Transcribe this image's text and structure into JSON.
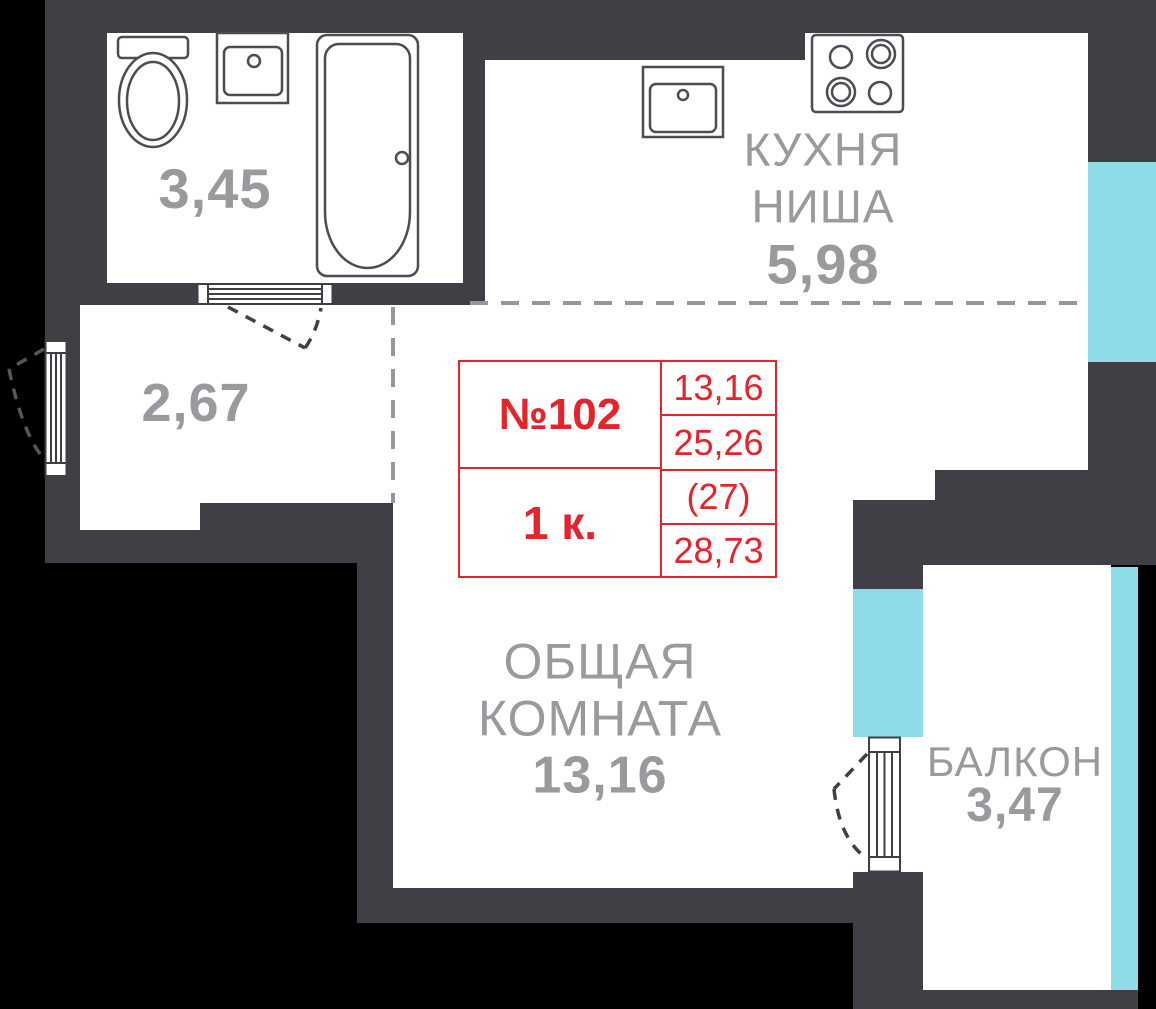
{
  "title": "Апартамент №102 — план",
  "colors": {
    "background": "#000000",
    "wall": "#3f3f45",
    "room_fill": "#ffffff",
    "window_glass": "#8edce8",
    "label_gray": "#9a9a9e",
    "accent_red": "#e4232b"
  },
  "unit": {
    "number": "№102",
    "type": "1 к.",
    "living_area": "13,16",
    "area_excl_balcony": "25,26",
    "area_hint": "(27)",
    "total_area": "28,73"
  },
  "rooms": {
    "bathroom": {
      "area": "3,45"
    },
    "kitchen": {
      "line1": "КУХНЯ",
      "line2": "НИША",
      "area": "5,98"
    },
    "hallway": {
      "area": "2,67"
    },
    "living": {
      "line1": "ОБЩАЯ",
      "line2": "КОМНАТА",
      "area": "13,16"
    },
    "balcony": {
      "name": "БАЛКОН",
      "area": "3,47"
    }
  },
  "icons": [
    "toilet-icon",
    "bathroom-sink-icon",
    "bathtub-icon",
    "kitchen-sink-icon",
    "stove-icon",
    "entry-door-icon",
    "bathroom-door-icon",
    "balcony-door-icon",
    "door-swing-arc",
    "room-divider-dashed"
  ]
}
